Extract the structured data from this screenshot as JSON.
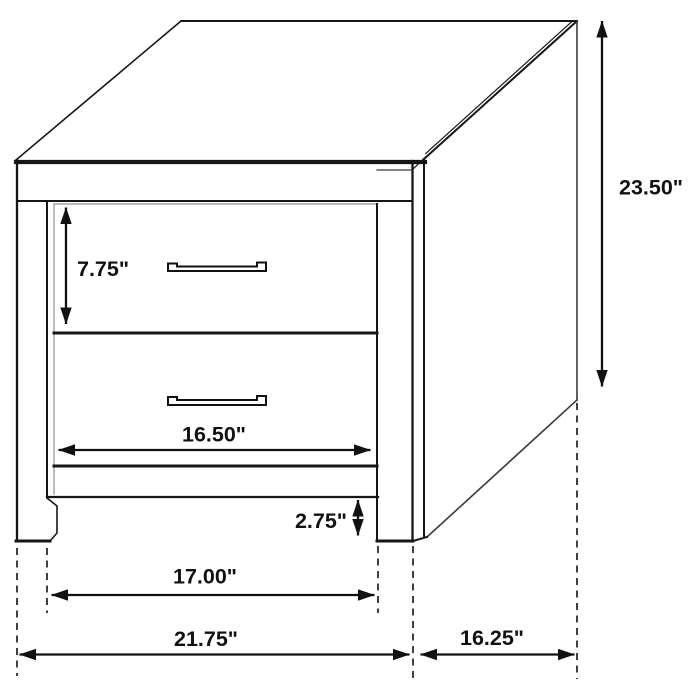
{
  "diagram": {
    "subject": "2-drawer nightstand dimensional drawing",
    "unit": "inches",
    "colors": {
      "line": "#161616",
      "dimension": "#111111",
      "background": "#ffffff"
    },
    "labels": {
      "overall_height": "23.50\"",
      "top_drawer_height": "7.75\"",
      "drawer_width": "16.50\"",
      "base_rail_height": "2.75\"",
      "leg_span_width": "17.00\"",
      "overall_width": "21.75\"",
      "overall_depth": "16.25\""
    }
  }
}
